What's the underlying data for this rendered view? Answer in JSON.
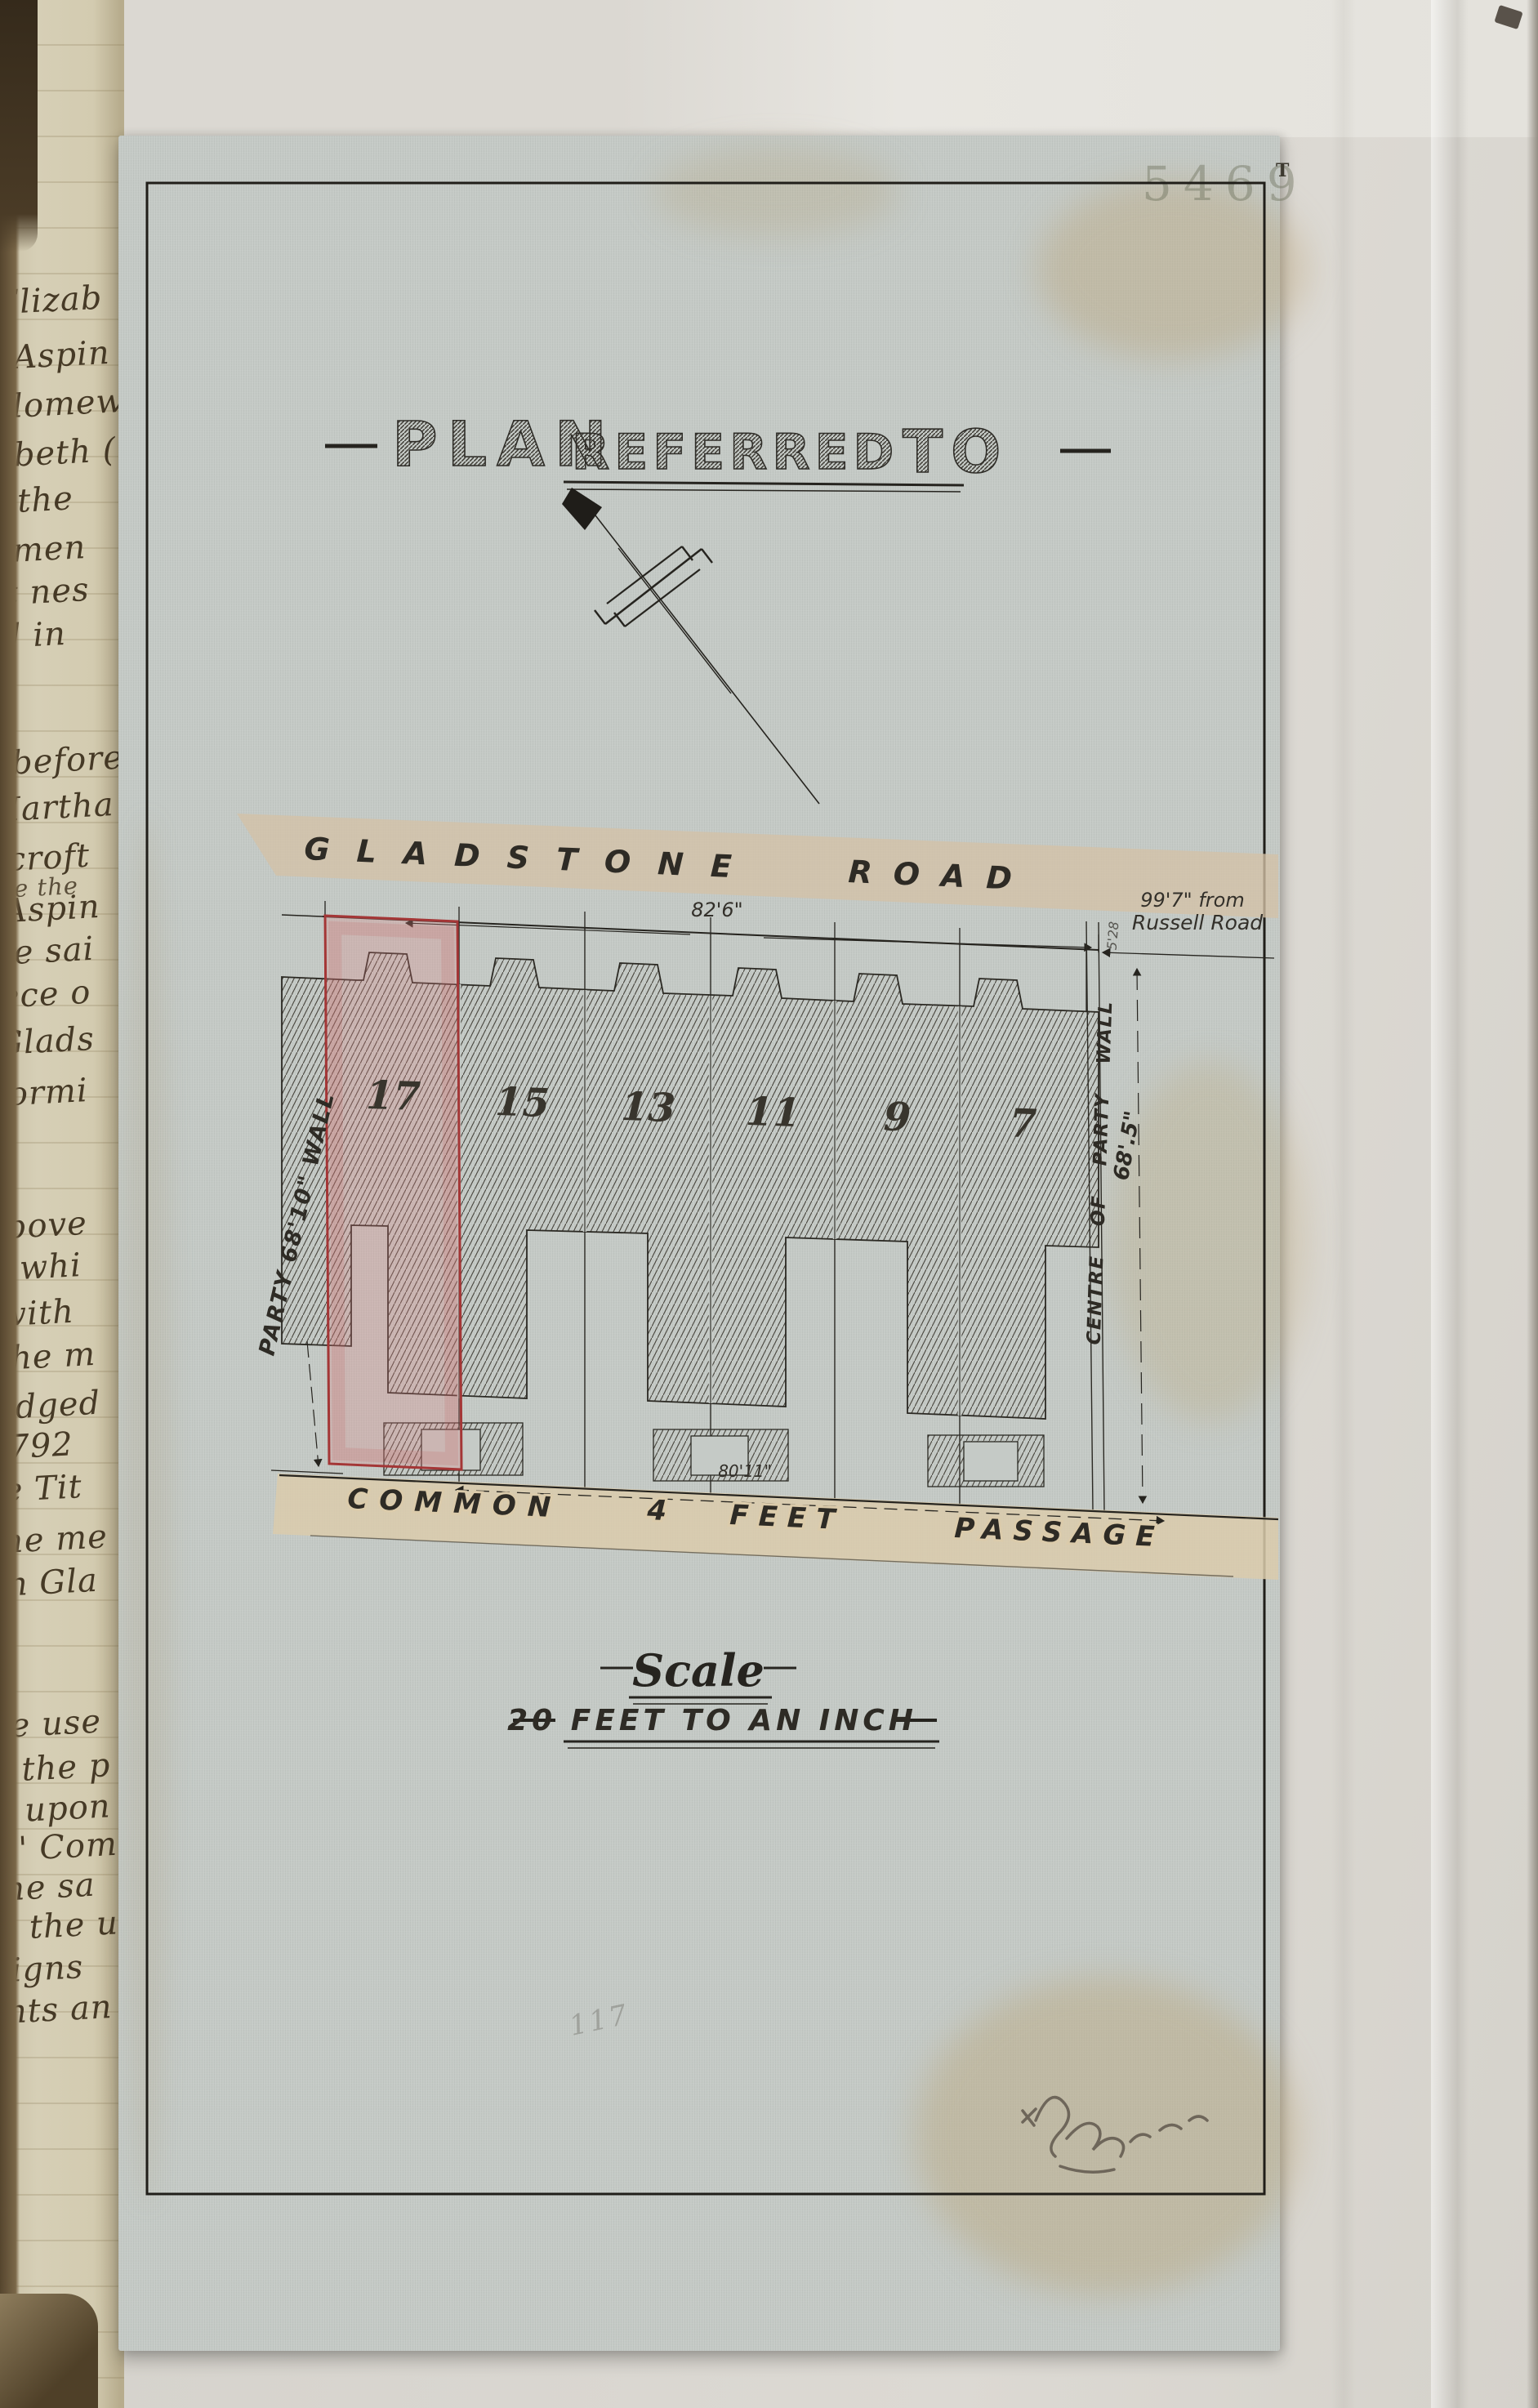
{
  "page": {
    "archival_number": "5469",
    "corner_mark": "T"
  },
  "title": {
    "word1": "PLAN",
    "word2": "REFERRED",
    "word3": "TO"
  },
  "plan": {
    "road": {
      "word1": "GLADSTONE",
      "word2": "ROAD",
      "frontage_dimension": "82'6\"",
      "distance_line1": "99'7\" from",
      "distance_line2": "Russell Road"
    },
    "plots": [
      {
        "number": "17"
      },
      {
        "number": "15"
      },
      {
        "number": "13"
      },
      {
        "number": "11"
      },
      {
        "number": "9"
      },
      {
        "number": "7"
      }
    ],
    "left_wall_label": "PARTY 68'10\" WALL",
    "right_wall_label": "CENTRE OF PARTY WALL",
    "right_wall_dimension": "68'.5\"",
    "end_dimension": "5'28",
    "passage": {
      "word1": "COMMON",
      "word2": "4",
      "word3": "FEET",
      "word4": "PASSAGE",
      "dimension": "80'11\""
    }
  },
  "scale": {
    "heading": "Scale",
    "line": "20 FEET TO AN INCH"
  },
  "annotations": {
    "pencil_number": "117"
  },
  "manuscript": {
    "lines": [
      "Elizab",
      "Aspin",
      "olomew",
      "abeth (",
      "s the",
      "amen",
      "it nes",
      "d in",
      "before",
      "Martha",
      "hcroft",
      "dge the",
      "Aspin",
      "he sai",
      "iece o",
      "Glads",
      "formi",
      "above",
      "whi",
      "with",
      "the m",
      "edged",
      "1792",
      "le Tit",
      "the me",
      "in Gla",
      "ee use",
      "n the p",
      "g upon",
      "in' Comm",
      "the sa",
      "to the us",
      "signs",
      "ants an"
    ]
  }
}
